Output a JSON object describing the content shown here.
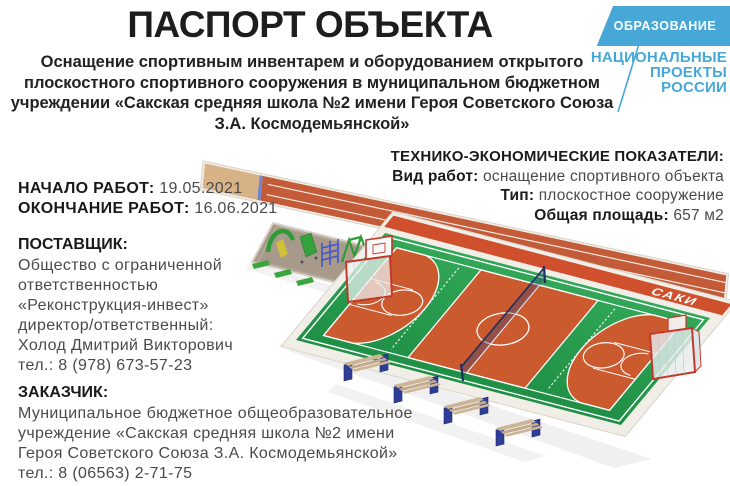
{
  "header": {
    "title": "ПАСПОРТ ОБЪЕКТА",
    "subtitle": "Оснащение спортивным инвентарем и оборудованием открытого плоскостного спортивного сооружения в муниципальном бюджетном учреждении «Сакская средняя школа №2 имени Героя Советского Союза З.А. Космодемьянской»"
  },
  "logo": {
    "program": "ОБРАЗОВАНИЕ",
    "brand_lines": [
      "НАЦИОНАЛЬНЫЕ",
      "ПРОЕКТЫ",
      "РОССИИ"
    ],
    "accent_color": "#47a8d8"
  },
  "timeline": {
    "start_label": "НАЧАЛО РАБОТ:",
    "start_value": "19.05.2021",
    "finish_label": "ОКОНЧАНИЕ РАБОТ:",
    "finish_value": "16.06.2021"
  },
  "supplier": {
    "label": "ПОСТАВЩИК:",
    "lines": [
      "Общество с ограниченной",
      "ответственностью",
      "«Реконструкция-инвест»",
      "директор/ответственный:",
      "Холод Дмитрий Викторович",
      "тел.: 8 (978) 673-57-23"
    ]
  },
  "customer": {
    "label": "ЗАКАЗЧИК:",
    "lines": [
      "Муниципальное бюджетное общеобразовательное",
      "учреждение «Сакская средняя школа №2 имени",
      "Героя Советского Союза З.А. Космодемьянской»",
      "тел.: 8 (06563) 2-71-75"
    ]
  },
  "indicators": {
    "title": "ТЕХНИКО-ЭКОНОМИЧЕСКИЕ ПОКАЗАТЕЛИ:",
    "rows": [
      {
        "label": "Вид работ:",
        "value": "оснащение спортивного объекта"
      },
      {
        "label": "Тип:",
        "value": "плоскостное сооружение"
      },
      {
        "label": "Общая площадь:",
        "value": "657 м2"
      }
    ]
  },
  "render": {
    "city_banner": "САКИ",
    "colors": {
      "court_green": "#2da050",
      "zone_orange": "#cc5a2f",
      "track_orange": "#c45b38",
      "banner_red": "#d0502e",
      "sand": "#d8b287",
      "bench_blue": "#2e3d96",
      "goal_red": "#c2392b"
    }
  }
}
